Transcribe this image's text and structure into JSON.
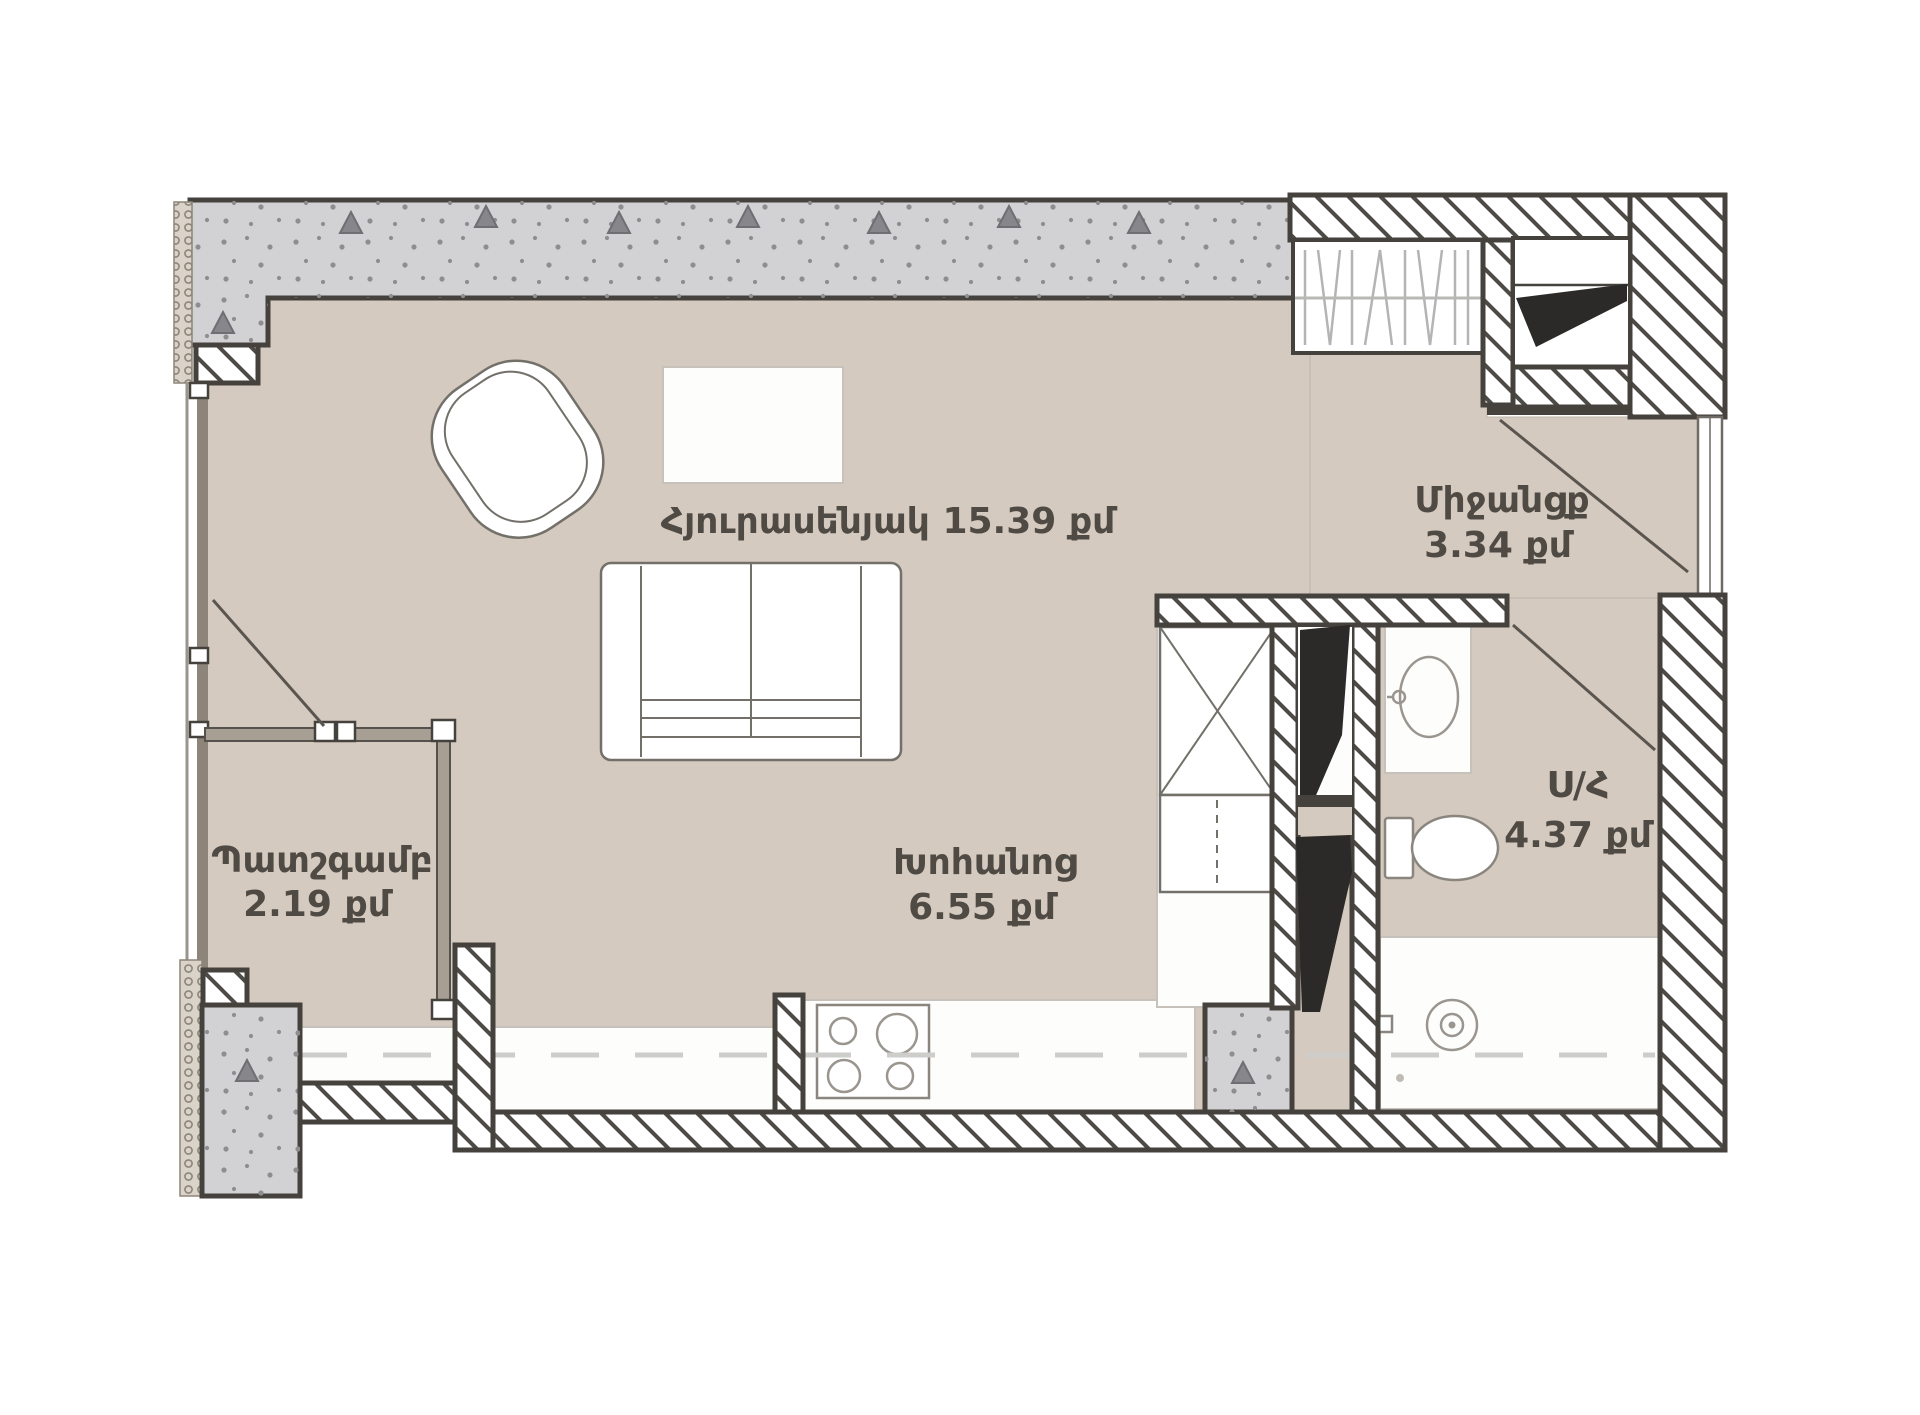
{
  "plan": {
    "rooms": {
      "living": {
        "label": "Հյուրասենյակ 15.39 քմ"
      },
      "corridor": {
        "name": "Միջանցք",
        "area": "3.34 քմ"
      },
      "balcony": {
        "name": "Պատշգամբ",
        "area": "2.19 քմ"
      },
      "kitchen": {
        "name": "Խոհանոց",
        "area": "6.55 քմ"
      },
      "bathroom": {
        "name": "Ս/Հ",
        "area": "4.37 քմ"
      }
    },
    "colors": {
      "floor_beige": "#d5cabf",
      "concrete_gray": "#d2d2d4",
      "wall_line": "#45423e",
      "label_text": "#4f4a44"
    }
  }
}
